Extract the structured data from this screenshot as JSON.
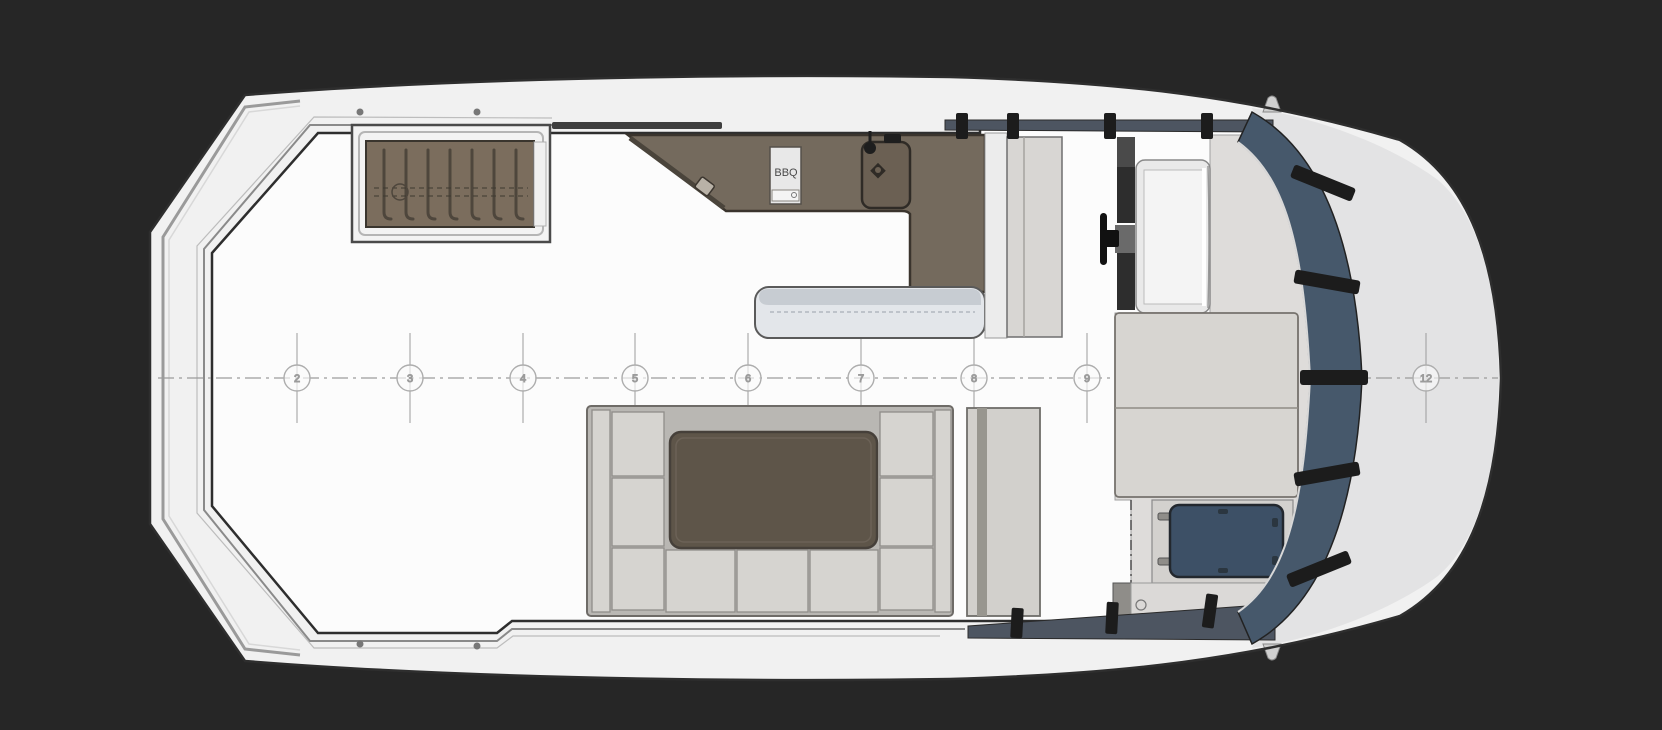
{
  "drawing": {
    "type": "yacht-flybridge-deck-plan",
    "view": "top-down"
  },
  "colors": {
    "background": "#262626",
    "hull": "#f1f1f1",
    "hull_outline": "#2e2e2e",
    "foredeck": "#e3e3e4",
    "deck": "#fcfcfc",
    "windshield": "#46586b",
    "windshield_strip": "#4d5561",
    "hatch_blue": "#3d5066",
    "bar_brown": "#746a5d",
    "stairs_brown": "#7b6d5d",
    "stair_tread": "#4e463c",
    "table_brown": "#5e5549",
    "bench": "#e3e6ea",
    "bench_top": "#c7ccd2",
    "sofa_cushion": "#d6d4d0",
    "sofa_base": "#b9b7b3",
    "sunpad": "#d7d5d1",
    "cabinet": "#d8d6d3",
    "platform": "#dedcda",
    "mullion": "#1c1c1c",
    "rail_strip": "#3f3f3f",
    "centerline": "#9b9b9b",
    "station_text": "#999999",
    "grill_body": "#e8e8e8"
  },
  "centerline": {
    "y": 378,
    "x_start": 158,
    "x_end": 1498,
    "tick_half": 45,
    "stations": [
      {
        "label": "2",
        "x": 297
      },
      {
        "label": "3",
        "x": 410
      },
      {
        "label": "4",
        "x": 523
      },
      {
        "label": "5",
        "x": 635
      },
      {
        "label": "6",
        "x": 748
      },
      {
        "label": "7",
        "x": 861
      },
      {
        "label": "8",
        "x": 974
      },
      {
        "label": "9",
        "x": 1087
      },
      {
        "label": "12",
        "x": 1426
      }
    ]
  },
  "labels": {
    "bbq_grill": "BBQ"
  },
  "equipment_icons": [
    {
      "name": "stairway-icon"
    },
    {
      "name": "wet-bar-icon"
    },
    {
      "name": "bbq-grill-icon"
    },
    {
      "name": "sink-icon"
    },
    {
      "name": "faucet-icon"
    },
    {
      "name": "bench-seat-icon"
    },
    {
      "name": "steering-wheel-icon"
    },
    {
      "name": "helm-console-icon"
    },
    {
      "name": "sunpad-icon"
    },
    {
      "name": "skylight-hatch-icon"
    },
    {
      "name": "u-sofa-icon"
    },
    {
      "name": "cockpit-table-icon"
    },
    {
      "name": "windshield-icon"
    },
    {
      "name": "bow-light-icon"
    }
  ]
}
